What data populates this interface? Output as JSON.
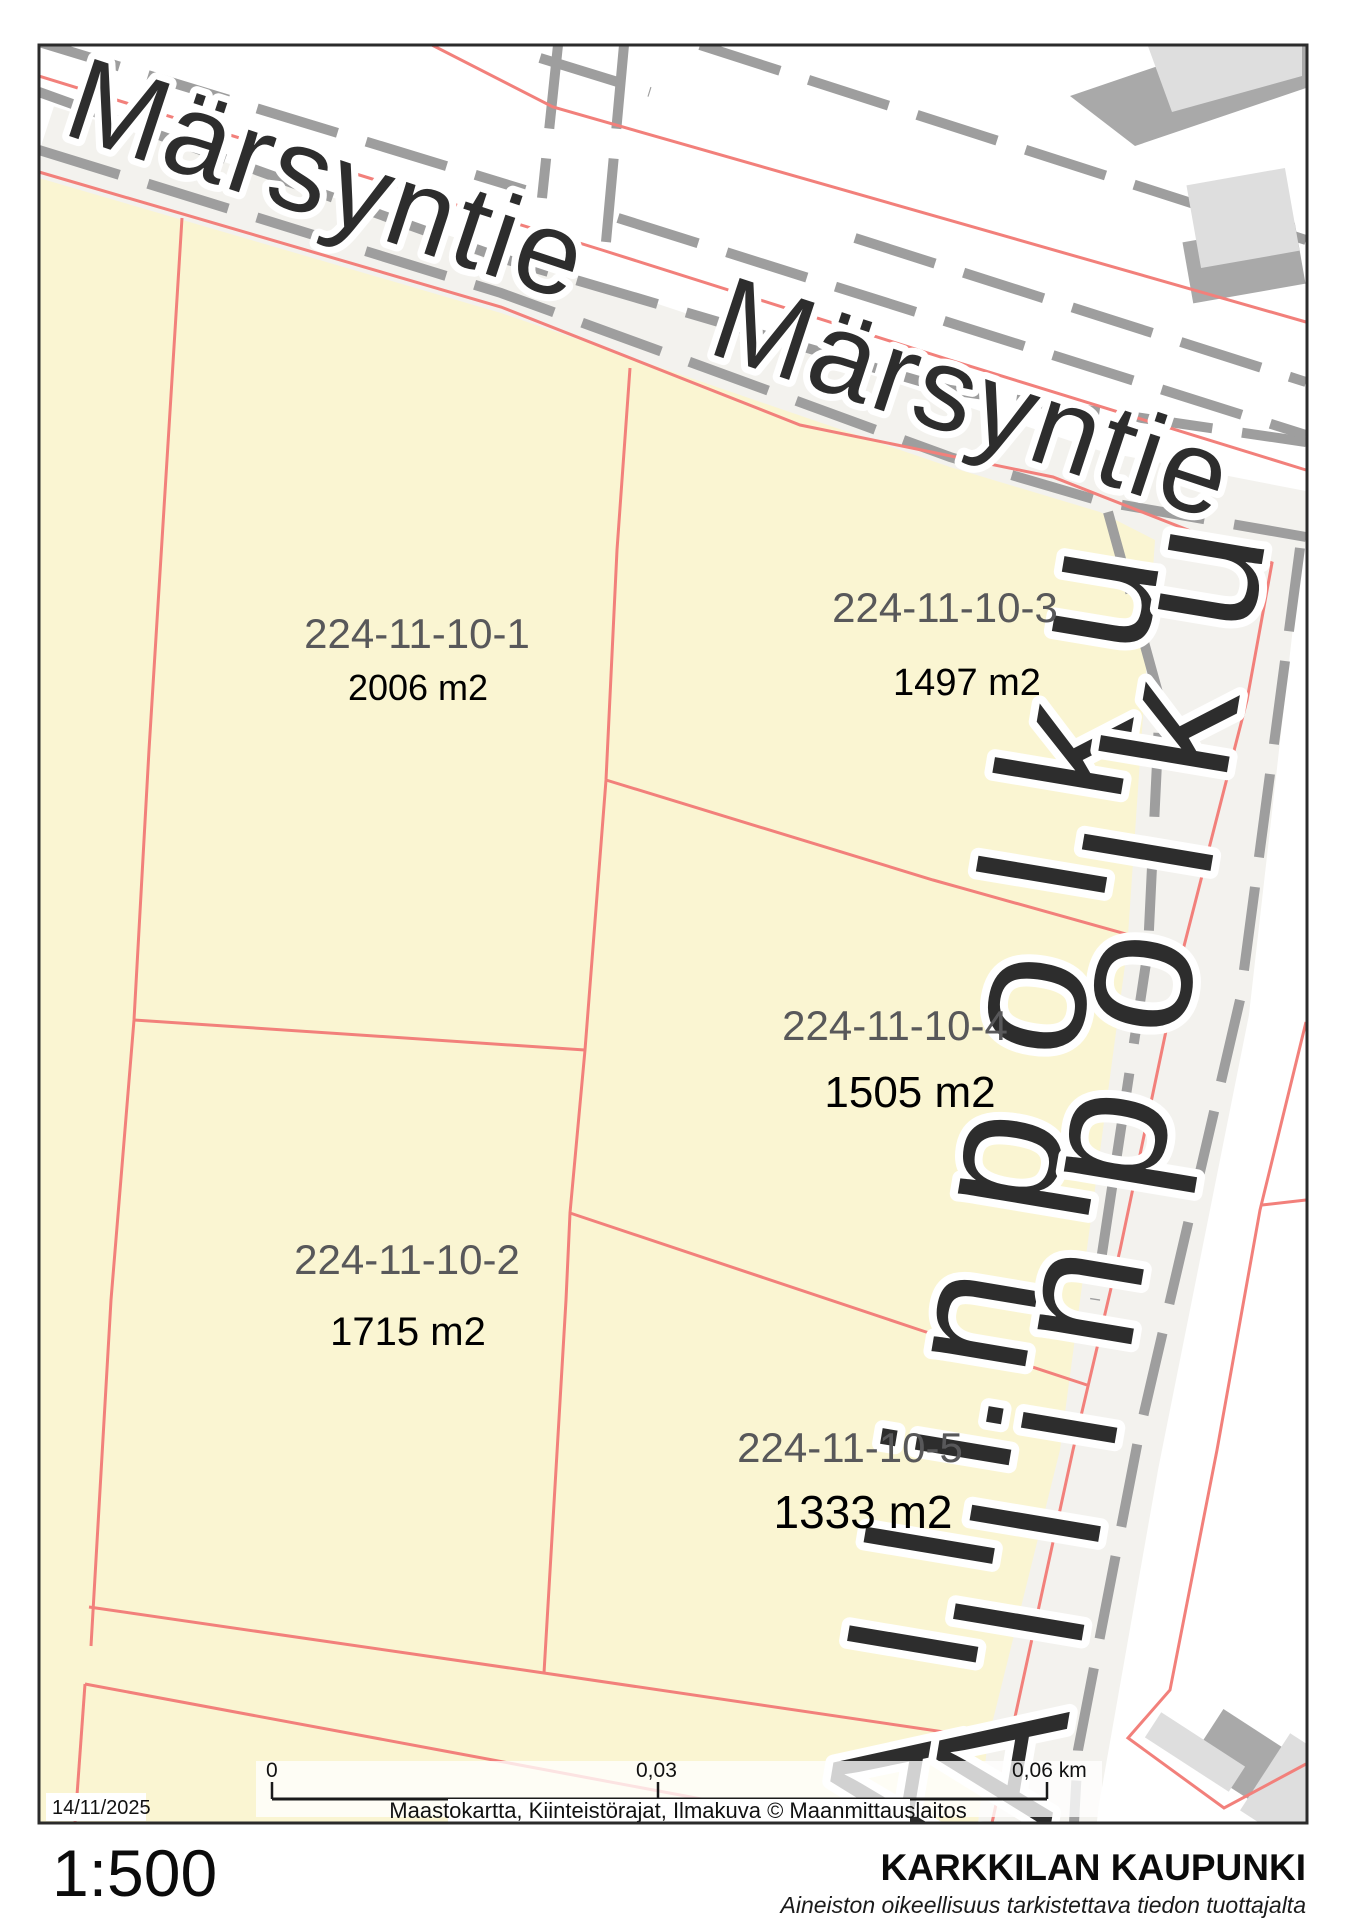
{
  "map": {
    "title_hint": "cadastral parcel map",
    "streets": {
      "marsyntie_1": "Märsyntie",
      "marsyntie_2": "Märsyntie",
      "allinpolku_1": "Allinpolku",
      "allinpolku_2": "Allinpolku"
    },
    "parcels": [
      {
        "id": "224-11-10-1",
        "area": "2006 m2"
      },
      {
        "id": "224-11-10-3",
        "area": "1497 m2"
      },
      {
        "id": "224-11-10-4",
        "area": "1505 m2"
      },
      {
        "id": "224-11-10-2",
        "area": "1715 m2"
      },
      {
        "id": "224-11-10-5",
        "area": "1333 m2"
      }
    ],
    "scalebar": {
      "start": "0",
      "middle": "0,03",
      "end": "0,06 km"
    },
    "date": "14/11/2025",
    "attribution": "Maastokartta, Kiinteistörajat, Ilmakuva  ©  Maanmittauslaitos"
  },
  "footer": {
    "scale": "1:500",
    "municipality": "KARKKILAN KAUPUNKI",
    "disclaimer": "Aineiston oikeellisuus tarkistettava tiedon tuottajalta"
  },
  "colors": {
    "parcel_fill": "#faf5d2",
    "boundary_red": "#f2807b",
    "road_casing_gray": "#9e9e9e",
    "building_dark": "#a9a9a9",
    "building_light": "#dedede",
    "parcel_id_text": "#58585a",
    "frame": "#2b2b2b"
  }
}
